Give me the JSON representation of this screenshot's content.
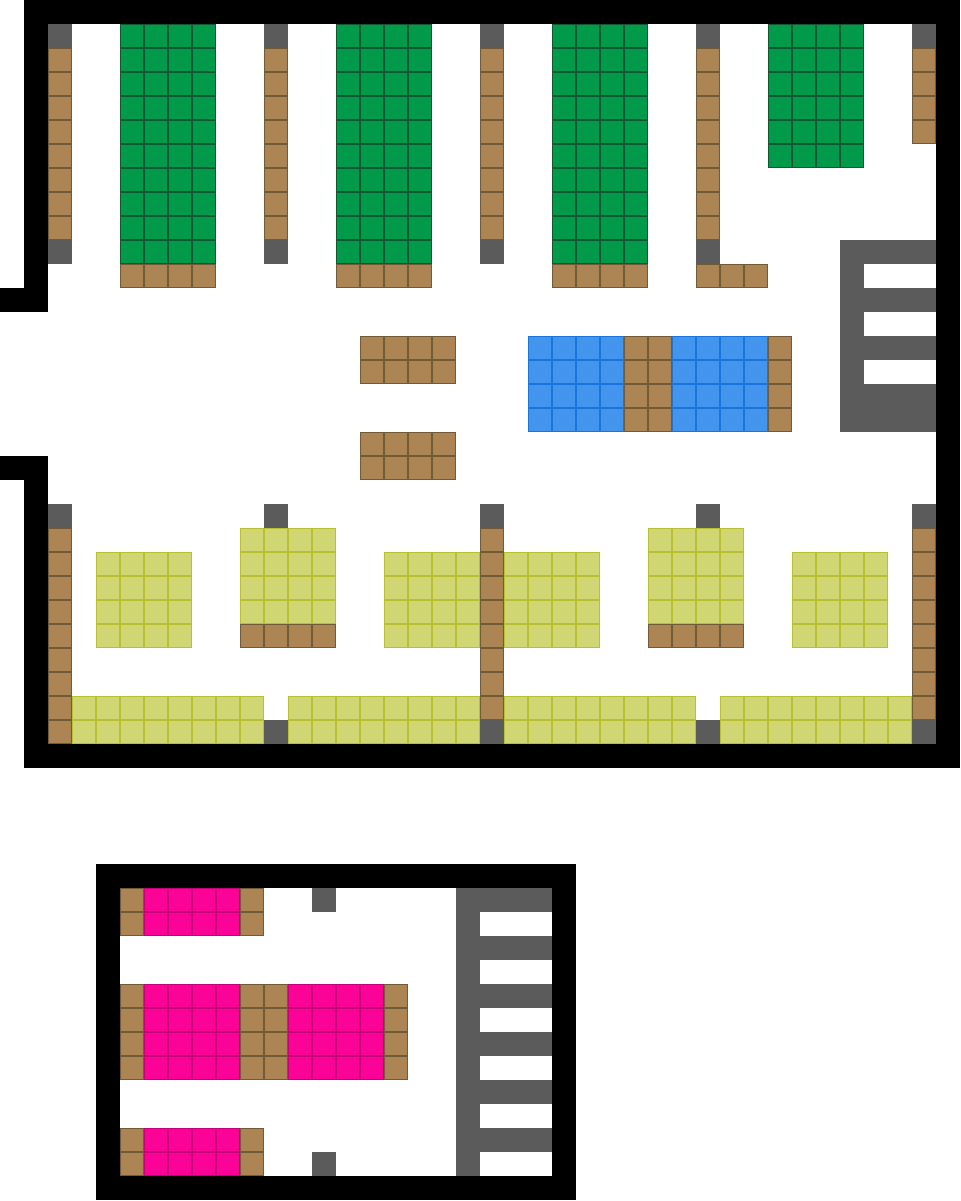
{
  "map": {
    "canvas_width_px": 961,
    "canvas_height_px": 1201,
    "tile_size_px": 24,
    "background_color": "#ffffff",
    "palette": {
      "black": {
        "fill": "#000000"
      },
      "gray": {
        "fill": "#5b5b5b"
      },
      "green": {
        "fill": "#019a4a",
        "line": "#0e5931"
      },
      "brown": {
        "fill": "#ad8453",
        "line": "#715a36"
      },
      "blue": {
        "fill": "#4294ec",
        "line": "#1a74dc"
      },
      "yellow": {
        "fill": "#d1d675",
        "line": "#b9bf33"
      },
      "pink": {
        "fill": "#fc0398",
        "line": "#c6027a"
      }
    },
    "rects": [
      {
        "name": "upper-wall-top",
        "type": "black",
        "x": 24,
        "y": 0,
        "w": 936,
        "h": 24
      },
      {
        "name": "upper-wall-left-top",
        "type": "black",
        "x": 24,
        "y": 24,
        "w": 24,
        "h": 288
      },
      {
        "name": "upper-wall-left-top-notch",
        "type": "black",
        "x": 0,
        "y": 288,
        "w": 24,
        "h": 24
      },
      {
        "name": "upper-wall-left-bot-notch",
        "type": "black",
        "x": 0,
        "y": 456,
        "w": 24,
        "h": 24
      },
      {
        "name": "upper-wall-left-bottom",
        "type": "black",
        "x": 24,
        "y": 456,
        "w": 24,
        "h": 288
      },
      {
        "name": "upper-wall-bottom",
        "type": "black",
        "x": 24,
        "y": 744,
        "w": 936,
        "h": 24
      },
      {
        "name": "upper-wall-right",
        "type": "black",
        "x": 936,
        "y": 24,
        "w": 24,
        "h": 720
      },
      {
        "name": "pillar-1-cap-top",
        "type": "gray",
        "x": 48,
        "y": 24,
        "w": 24,
        "h": 24
      },
      {
        "name": "pillar-1-brown",
        "type": "brown",
        "x": 48,
        "y": 48,
        "w": 24,
        "h": 192
      },
      {
        "name": "pillar-1-cap-bot",
        "type": "gray",
        "x": 48,
        "y": 240,
        "w": 24,
        "h": 24
      },
      {
        "name": "green-shelf-1",
        "type": "green",
        "x": 120,
        "y": 24,
        "w": 96,
        "h": 240
      },
      {
        "name": "green-shelf-1-base",
        "type": "brown",
        "x": 120,
        "y": 264,
        "w": 96,
        "h": 24
      },
      {
        "name": "pillar-2-cap-top",
        "type": "gray",
        "x": 264,
        "y": 24,
        "w": 24,
        "h": 24
      },
      {
        "name": "pillar-2-brown",
        "type": "brown",
        "x": 264,
        "y": 48,
        "w": 24,
        "h": 192
      },
      {
        "name": "pillar-2-cap-bot",
        "type": "gray",
        "x": 264,
        "y": 240,
        "w": 24,
        "h": 24
      },
      {
        "name": "green-shelf-2",
        "type": "green",
        "x": 336,
        "y": 24,
        "w": 96,
        "h": 240
      },
      {
        "name": "green-shelf-2-base",
        "type": "brown",
        "x": 336,
        "y": 264,
        "w": 96,
        "h": 24
      },
      {
        "name": "pillar-3-cap-top",
        "type": "gray",
        "x": 480,
        "y": 24,
        "w": 24,
        "h": 24
      },
      {
        "name": "pillar-3-brown",
        "type": "brown",
        "x": 480,
        "y": 48,
        "w": 24,
        "h": 192
      },
      {
        "name": "pillar-3-cap-bot",
        "type": "gray",
        "x": 480,
        "y": 240,
        "w": 24,
        "h": 24
      },
      {
        "name": "green-shelf-3",
        "type": "green",
        "x": 552,
        "y": 24,
        "w": 96,
        "h": 240
      },
      {
        "name": "green-shelf-3-base",
        "type": "brown",
        "x": 552,
        "y": 264,
        "w": 96,
        "h": 24
      },
      {
        "name": "pillar-4-cap-top",
        "type": "gray",
        "x": 696,
        "y": 24,
        "w": 24,
        "h": 24
      },
      {
        "name": "pillar-4-brown",
        "type": "brown",
        "x": 696,
        "y": 48,
        "w": 24,
        "h": 192
      },
      {
        "name": "pillar-4-cap-bot",
        "type": "gray",
        "x": 696,
        "y": 240,
        "w": 24,
        "h": 24
      },
      {
        "name": "pillar-4-base-row",
        "type": "brown",
        "x": 696,
        "y": 264,
        "w": 72,
        "h": 24
      },
      {
        "name": "green-shelf-4",
        "type": "green",
        "x": 768,
        "y": 24,
        "w": 96,
        "h": 144
      },
      {
        "name": "pillar-5-cap-top",
        "type": "gray",
        "x": 912,
        "y": 24,
        "w": 24,
        "h": 24
      },
      {
        "name": "pillar-5-brown",
        "type": "brown",
        "x": 912,
        "y": 48,
        "w": 24,
        "h": 96
      },
      {
        "name": "brown-table-1",
        "type": "brown",
        "x": 360,
        "y": 336,
        "w": 96,
        "h": 48
      },
      {
        "name": "brown-table-2",
        "type": "brown",
        "x": 360,
        "y": 432,
        "w": 96,
        "h": 48
      },
      {
        "name": "blue-shelf-1",
        "type": "blue",
        "x": 528,
        "y": 336,
        "w": 96,
        "h": 96
      },
      {
        "name": "blue-shelf-divider",
        "type": "brown",
        "x": 624,
        "y": 336,
        "w": 48,
        "h": 96
      },
      {
        "name": "blue-shelf-2",
        "type": "blue",
        "x": 672,
        "y": 336,
        "w": 96,
        "h": 96
      },
      {
        "name": "blue-shelf-end",
        "type": "brown",
        "x": 768,
        "y": 336,
        "w": 24,
        "h": 96
      },
      {
        "name": "gray-rack-bar",
        "type": "gray",
        "x": 840,
        "y": 240,
        "w": 24,
        "h": 192
      },
      {
        "name": "gray-rack-arm-1",
        "type": "gray",
        "x": 864,
        "y": 240,
        "w": 72,
        "h": 24
      },
      {
        "name": "gray-rack-arm-2",
        "type": "gray",
        "x": 864,
        "y": 288,
        "w": 72,
        "h": 24
      },
      {
        "name": "gray-rack-arm-3",
        "type": "gray",
        "x": 864,
        "y": 336,
        "w": 72,
        "h": 24
      },
      {
        "name": "gray-rack-base",
        "type": "gray",
        "x": 840,
        "y": 384,
        "w": 96,
        "h": 48
      },
      {
        "name": "pillar-6-cap-top",
        "type": "gray",
        "x": 48,
        "y": 504,
        "w": 24,
        "h": 24
      },
      {
        "name": "pillar-6-brown",
        "type": "brown",
        "x": 48,
        "y": 528,
        "w": 24,
        "h": 216
      },
      {
        "name": "yellow-shelf-a",
        "type": "yellow",
        "x": 96,
        "y": 552,
        "w": 96,
        "h": 96
      },
      {
        "name": "pillar-7-cap",
        "type": "gray",
        "x": 264,
        "y": 504,
        "w": 24,
        "h": 24
      },
      {
        "name": "yellow-shelf-b",
        "type": "yellow",
        "x": 240,
        "y": 528,
        "w": 96,
        "h": 96
      },
      {
        "name": "yellow-shelf-b-base",
        "type": "brown",
        "x": 240,
        "y": 624,
        "w": 96,
        "h": 24
      },
      {
        "name": "pillar-8-cap-top",
        "type": "gray",
        "x": 480,
        "y": 504,
        "w": 24,
        "h": 24
      },
      {
        "name": "yellow-shelf-c-left",
        "type": "yellow",
        "x": 384,
        "y": 552,
        "w": 96,
        "h": 96
      },
      {
        "name": "pillar-8-brown",
        "type": "brown",
        "x": 480,
        "y": 528,
        "w": 24,
        "h": 192
      },
      {
        "name": "yellow-shelf-c-right",
        "type": "yellow",
        "x": 504,
        "y": 552,
        "w": 96,
        "h": 96
      },
      {
        "name": "pillar-8-cap-bot",
        "type": "gray",
        "x": 480,
        "y": 720,
        "w": 24,
        "h": 24
      },
      {
        "name": "pillar-9-cap",
        "type": "gray",
        "x": 696,
        "y": 504,
        "w": 24,
        "h": 24
      },
      {
        "name": "yellow-shelf-d",
        "type": "yellow",
        "x": 648,
        "y": 528,
        "w": 96,
        "h": 96
      },
      {
        "name": "yellow-shelf-d-base",
        "type": "brown",
        "x": 648,
        "y": 624,
        "w": 96,
        "h": 24
      },
      {
        "name": "yellow-shelf-e",
        "type": "yellow",
        "x": 792,
        "y": 552,
        "w": 96,
        "h": 96
      },
      {
        "name": "pillar-10-cap-top",
        "type": "gray",
        "x": 912,
        "y": 504,
        "w": 24,
        "h": 24
      },
      {
        "name": "pillar-10-brown",
        "type": "brown",
        "x": 912,
        "y": 528,
        "w": 24,
        "h": 192
      },
      {
        "name": "pillar-10-cap-bot",
        "type": "gray",
        "x": 912,
        "y": 720,
        "w": 24,
        "h": 24
      },
      {
        "name": "yellow-band-1",
        "type": "yellow",
        "x": 72,
        "y": 696,
        "w": 192,
        "h": 48
      },
      {
        "name": "yellow-band-2",
        "type": "yellow",
        "x": 288,
        "y": 696,
        "w": 192,
        "h": 48
      },
      {
        "name": "yellow-band-3",
        "type": "yellow",
        "x": 504,
        "y": 696,
        "w": 192,
        "h": 48
      },
      {
        "name": "yellow-band-4",
        "type": "yellow",
        "x": 720,
        "y": 696,
        "w": 192,
        "h": 48
      },
      {
        "name": "band-gray-tile-1",
        "type": "gray",
        "x": 264,
        "y": 720,
        "w": 24,
        "h": 24
      },
      {
        "name": "band-gray-tile-2",
        "type": "gray",
        "x": 696,
        "y": 720,
        "w": 24,
        "h": 24
      },
      {
        "name": "lower-wall-top",
        "type": "black",
        "x": 96,
        "y": 864,
        "w": 480,
        "h": 24
      },
      {
        "name": "lower-wall-left",
        "type": "black",
        "x": 96,
        "y": 888,
        "w": 24,
        "h": 312
      },
      {
        "name": "lower-wall-right",
        "type": "black",
        "x": 552,
        "y": 888,
        "w": 24,
        "h": 312
      },
      {
        "name": "lower-wall-bottom",
        "type": "black",
        "x": 96,
        "y": 1176,
        "w": 480,
        "h": 24
      },
      {
        "name": "pink-shelf-1-left-end",
        "type": "brown",
        "x": 120,
        "y": 888,
        "w": 24,
        "h": 48
      },
      {
        "name": "pink-shelf-1",
        "type": "pink",
        "x": 144,
        "y": 888,
        "w": 96,
        "h": 48
      },
      {
        "name": "pink-shelf-1-right-end",
        "type": "brown",
        "x": 240,
        "y": 888,
        "w": 24,
        "h": 48
      },
      {
        "name": "lower-gray-tile-top",
        "type": "gray",
        "x": 312,
        "y": 888,
        "w": 24,
        "h": 24
      },
      {
        "name": "pink-shelf-2-left-end",
        "type": "brown",
        "x": 120,
        "y": 984,
        "w": 24,
        "h": 96
      },
      {
        "name": "pink-shelf-2a",
        "type": "pink",
        "x": 144,
        "y": 984,
        "w": 96,
        "h": 96
      },
      {
        "name": "pink-shelf-2-divider",
        "type": "brown",
        "x": 240,
        "y": 984,
        "w": 48,
        "h": 96
      },
      {
        "name": "pink-shelf-2b",
        "type": "pink",
        "x": 288,
        "y": 984,
        "w": 96,
        "h": 96
      },
      {
        "name": "pink-shelf-2-right-end",
        "type": "brown",
        "x": 384,
        "y": 984,
        "w": 24,
        "h": 96
      },
      {
        "name": "pink-shelf-3-left-end",
        "type": "brown",
        "x": 120,
        "y": 1128,
        "w": 24,
        "h": 48
      },
      {
        "name": "pink-shelf-3",
        "type": "pink",
        "x": 144,
        "y": 1128,
        "w": 96,
        "h": 48
      },
      {
        "name": "pink-shelf-3-right-end",
        "type": "brown",
        "x": 240,
        "y": 1128,
        "w": 24,
        "h": 48
      },
      {
        "name": "lower-gray-tile-bottom",
        "type": "gray",
        "x": 312,
        "y": 1152,
        "w": 24,
        "h": 24
      },
      {
        "name": "lower-rack-bar",
        "type": "gray",
        "x": 456,
        "y": 888,
        "w": 24,
        "h": 288
      },
      {
        "name": "lower-rack-arm-1",
        "type": "gray",
        "x": 480,
        "y": 888,
        "w": 72,
        "h": 24
      },
      {
        "name": "lower-rack-arm-2",
        "type": "gray",
        "x": 480,
        "y": 936,
        "w": 72,
        "h": 24
      },
      {
        "name": "lower-rack-arm-3",
        "type": "gray",
        "x": 480,
        "y": 984,
        "w": 72,
        "h": 24
      },
      {
        "name": "lower-rack-arm-4",
        "type": "gray",
        "x": 480,
        "y": 1032,
        "w": 72,
        "h": 24
      },
      {
        "name": "lower-rack-arm-5",
        "type": "gray",
        "x": 480,
        "y": 1080,
        "w": 72,
        "h": 24
      },
      {
        "name": "lower-rack-arm-6",
        "type": "gray",
        "x": 480,
        "y": 1128,
        "w": 72,
        "h": 24
      }
    ]
  }
}
